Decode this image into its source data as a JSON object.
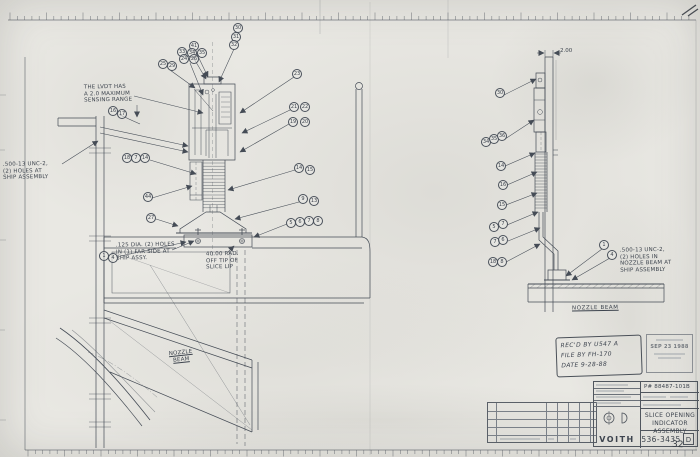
{
  "sheet": {
    "page_number": "32"
  },
  "annotations": {
    "lvdt_note": "THE LVDT HAS\nA 2.0 MAXIMUM\nSENSING RANGE",
    "left_holes_note": ".500-13 UNC-2,\n(2) HOLES AT\nSHIP ASSEMBLY",
    "dia_holes_note": ".125 DIA. (2) HOLES\nIN (1) FAR SIDE AT\nSHIP ASSY.",
    "radius_note": "40.00 RAD.\nOFF TIP OF\nSLICE LIP",
    "right_holes_note": ".500-13 UNC-2,\n(2) HOLES IN\nNOZZLE BEAM AT\nSHIP ASSEMBLY",
    "nozzle_beam_left": "NOZZLE\nBEAM",
    "nozzle_beam_right": "NOZZLE BEAM",
    "dim_2_00": "2.00"
  },
  "callouts_left": [
    {
      "x": 238,
      "y": 28,
      "label": "30"
    },
    {
      "x": 236,
      "y": 37,
      "label": "31"
    },
    {
      "x": 234,
      "y": 45,
      "label": "32"
    },
    {
      "x": 194,
      "y": 46,
      "label": "41"
    },
    {
      "x": 182,
      "y": 52,
      "label": "33"
    },
    {
      "x": 192,
      "y": 53,
      "label": "34"
    },
    {
      "x": 202,
      "y": 53,
      "label": "35"
    },
    {
      "x": 184,
      "y": 59,
      "label": "24"
    },
    {
      "x": 194,
      "y": 59,
      "label": "26"
    },
    {
      "x": 163,
      "y": 64,
      "label": "25"
    },
    {
      "x": 172,
      "y": 66,
      "label": "29"
    },
    {
      "x": 297,
      "y": 74,
      "label": "23"
    },
    {
      "x": 294,
      "y": 107,
      "label": "21"
    },
    {
      "x": 305,
      "y": 107,
      "label": "22"
    },
    {
      "x": 293,
      "y": 122,
      "label": "19"
    },
    {
      "x": 305,
      "y": 122,
      "label": "20"
    },
    {
      "x": 299,
      "y": 168,
      "label": "14"
    },
    {
      "x": 310,
      "y": 170,
      "label": "15"
    },
    {
      "x": 303,
      "y": 199,
      "label": "9"
    },
    {
      "x": 314,
      "y": 201,
      "label": "13"
    },
    {
      "x": 291,
      "y": 223,
      "label": "5"
    },
    {
      "x": 300,
      "y": 222,
      "label": "6"
    },
    {
      "x": 309,
      "y": 221,
      "label": "7"
    },
    {
      "x": 318,
      "y": 221,
      "label": "8"
    },
    {
      "x": 113,
      "y": 111,
      "label": "16"
    },
    {
      "x": 122,
      "y": 114,
      "label": "17"
    },
    {
      "x": 127,
      "y": 158,
      "label": "18"
    },
    {
      "x": 136,
      "y": 158,
      "label": "7"
    },
    {
      "x": 145,
      "y": 158,
      "label": "14"
    },
    {
      "x": 148,
      "y": 197,
      "label": "44"
    },
    {
      "x": 151,
      "y": 218,
      "label": "27"
    },
    {
      "x": 104,
      "y": 256,
      "label": "1"
    },
    {
      "x": 113,
      "y": 258,
      "label": "4"
    }
  ],
  "callouts_right": [
    {
      "x": 500,
      "y": 93,
      "label": "30"
    },
    {
      "x": 486,
      "y": 142,
      "label": "34"
    },
    {
      "x": 494,
      "y": 139,
      "label": "35"
    },
    {
      "x": 502,
      "y": 136,
      "label": "36"
    },
    {
      "x": 501,
      "y": 166,
      "label": "14"
    },
    {
      "x": 503,
      "y": 185,
      "label": "16"
    },
    {
      "x": 502,
      "y": 205,
      "label": "15"
    },
    {
      "x": 494,
      "y": 227,
      "label": "5"
    },
    {
      "x": 503,
      "y": 224,
      "label": "7"
    },
    {
      "x": 495,
      "y": 242,
      "label": "7"
    },
    {
      "x": 503,
      "y": 240,
      "label": "6"
    },
    {
      "x": 493,
      "y": 262,
      "label": "18"
    },
    {
      "x": 502,
      "y": 262,
      "label": "8"
    },
    {
      "x": 604,
      "y": 245,
      "label": "1"
    },
    {
      "x": 612,
      "y": 255,
      "label": "4"
    }
  ],
  "stamps": {
    "received_line1": "REC'D BY  U547 A",
    "received_line2": "FILE BY   FH-170",
    "received_line3": "DATE   9-28-88",
    "date_stamp": "SEP 23 1988"
  },
  "title_block": {
    "project_number": "P# 88487-101B",
    "title": "SLICE OPENING\nINDICATOR ASSEMBLY",
    "company": "VOITH",
    "drawing_number": "536-3435",
    "revision": "D"
  }
}
